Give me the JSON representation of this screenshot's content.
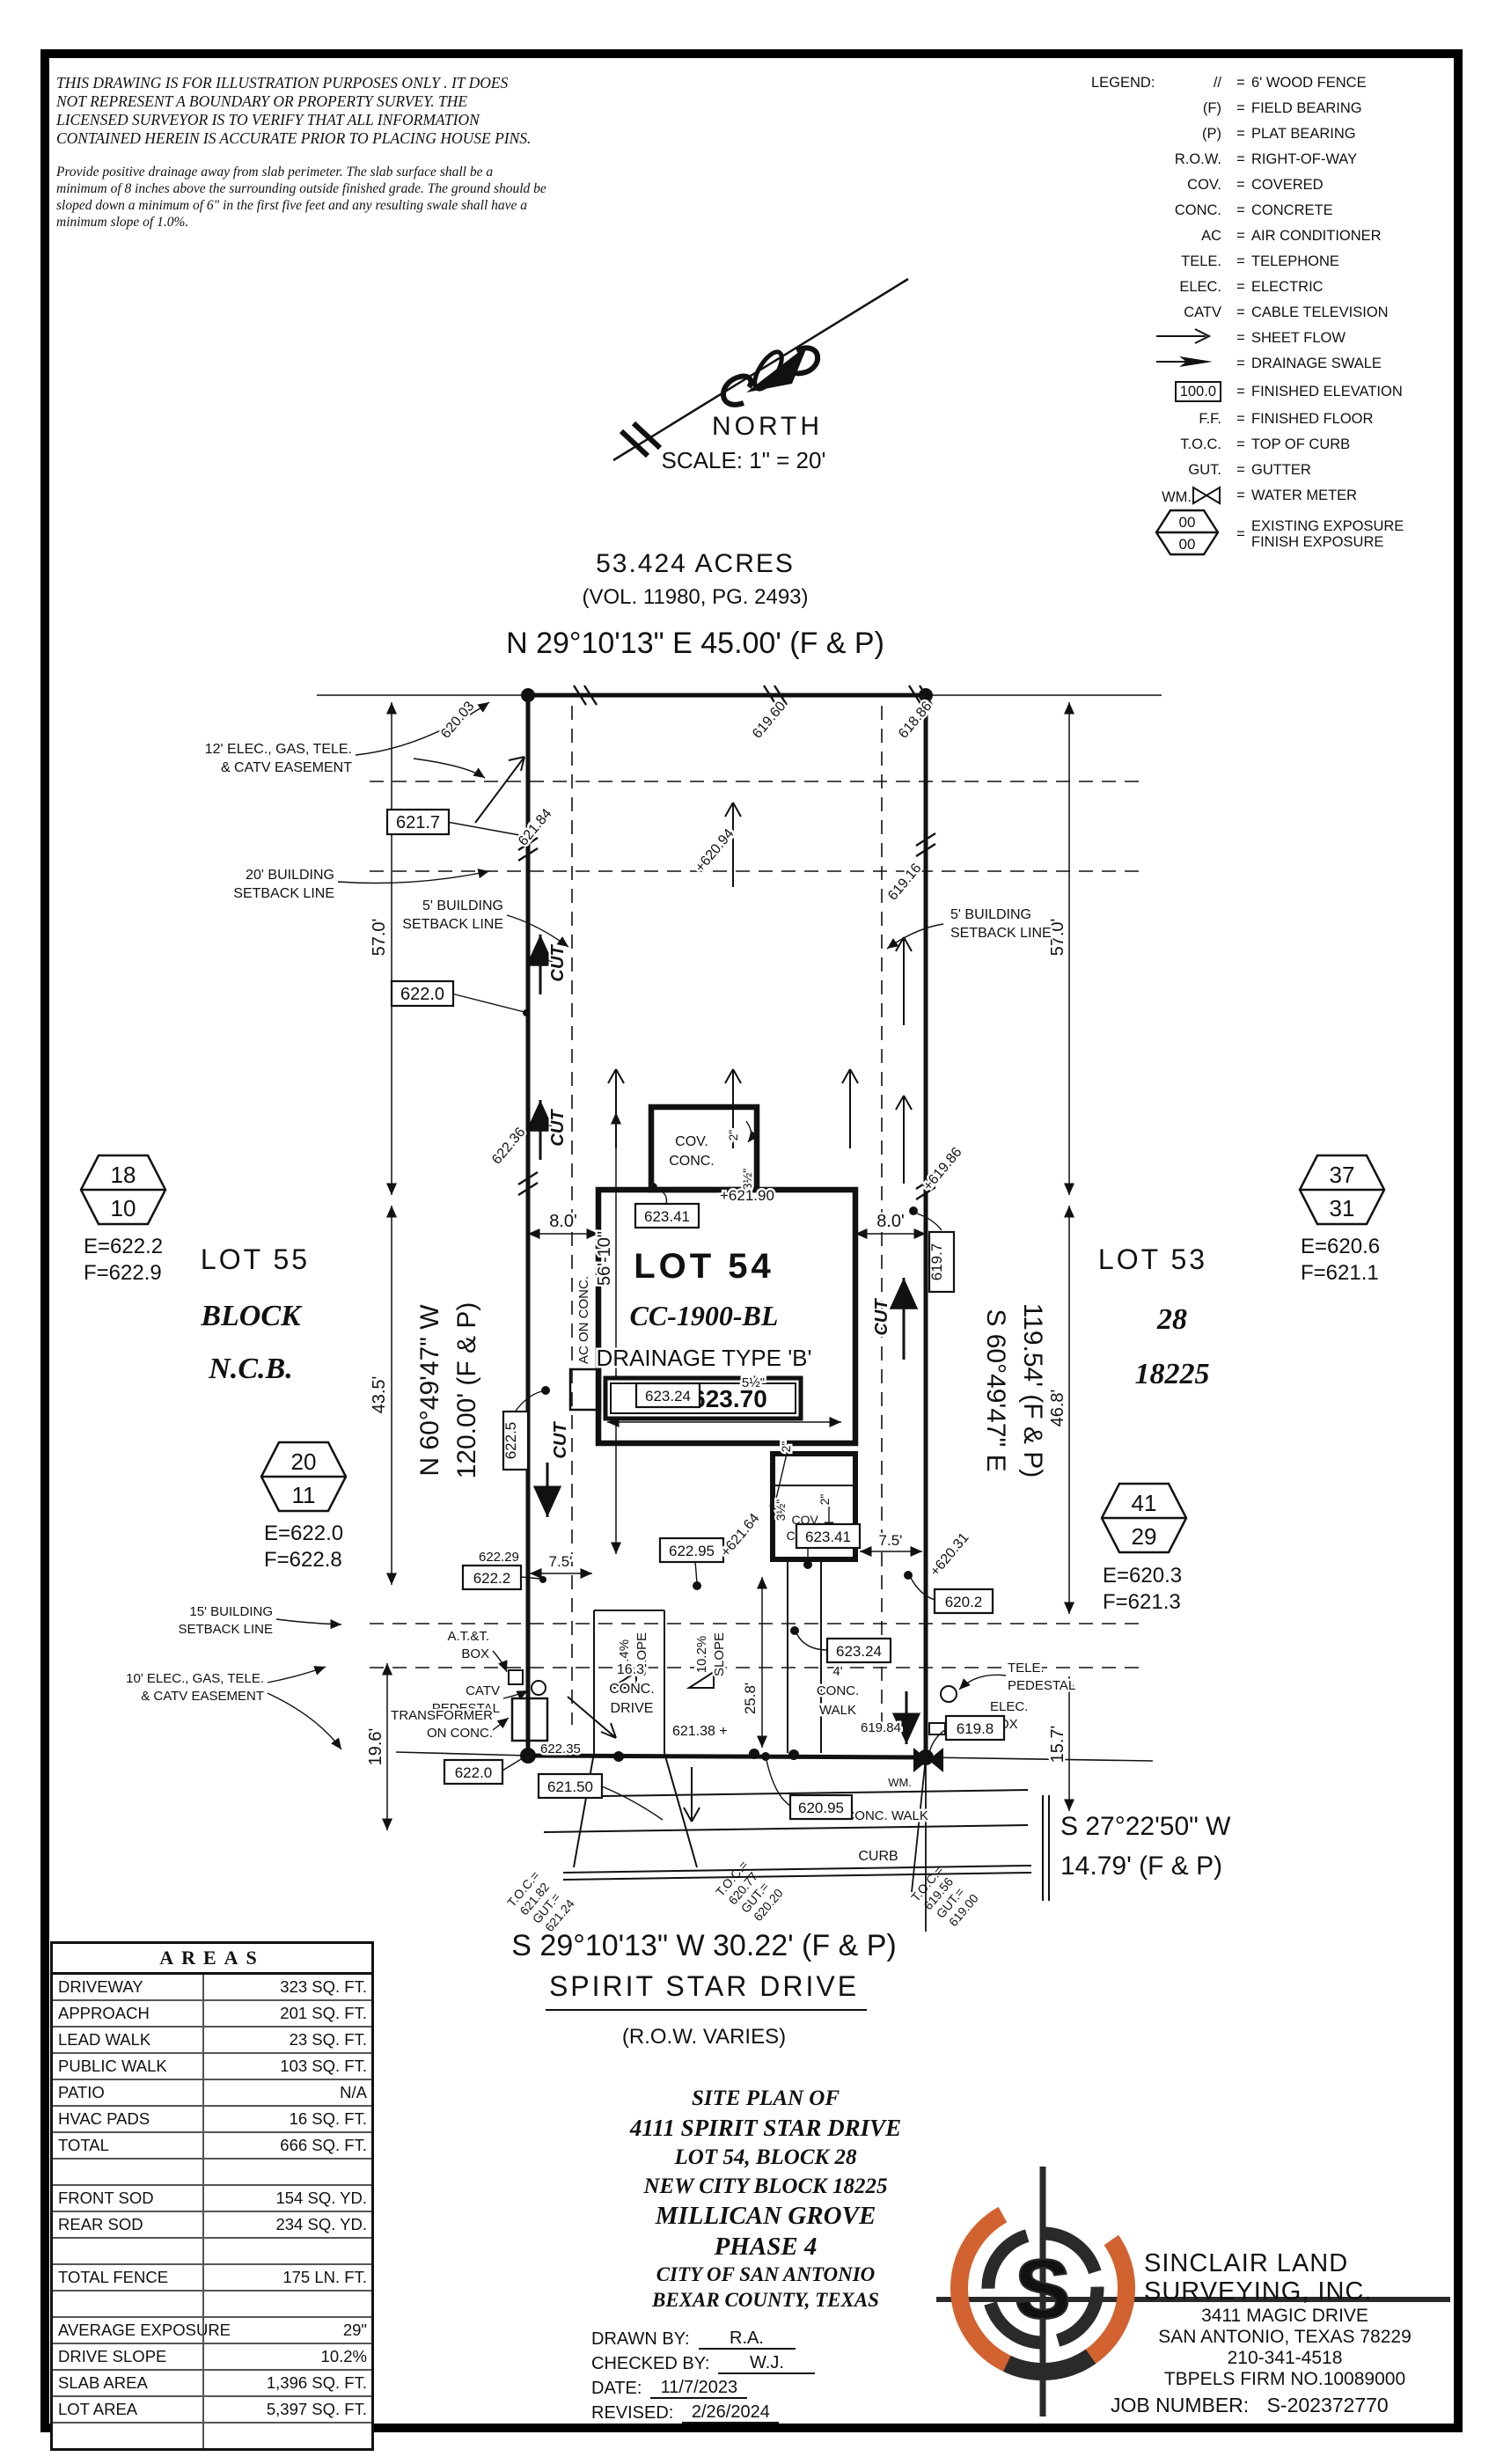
{
  "disclaimer": {
    "lines": [
      "THIS DRAWING IS FOR ILLUSTRATION PURPOSES ONLY . IT DOES",
      "NOT REPRESENT A BOUNDARY OR PROPERTY SURVEY. THE",
      "LICENSED SURVEYOR IS TO VERIFY THAT ALL INFORMATION",
      "CONTAINED HEREIN IS ACCURATE PRIOR TO PLACING HOUSE PINS."
    ]
  },
  "note": {
    "lines": [
      "Provide positive drainage away from slab perimeter. The slab surface shall be a",
      "minimum of 8 inches above the surrounding outside finished grade. The ground should be",
      "sloped down a minimum of 6\" in the first five feet and any resulting swale shall have a",
      "minimum slope of 1.0%."
    ]
  },
  "north": {
    "label": "NORTH",
    "scale": "SCALE: 1\" = 20'"
  },
  "legend": {
    "title": "LEGEND:",
    "fence_sym": "//",
    "fence": "6' WOOD FENCE",
    "f_sym": "(F)",
    "f": "FIELD BEARING",
    "p_sym": "(P)",
    "p": "PLAT BEARING",
    "row_sym": "R.O.W.",
    "row": "RIGHT-OF-WAY",
    "cov_sym": "COV.",
    "cov": "COVERED",
    "conc_sym": "CONC.",
    "conc": "CONCRETE",
    "ac_sym": "AC",
    "ac": "AIR CONDITIONER",
    "tele_sym": "TELE.",
    "tele": "TELEPHONE",
    "elec_sym": "ELEC.",
    "elec": "ELECTRIC",
    "catv_sym": "CATV",
    "catv": "CABLE TELEVISION",
    "sheet_flow": "SHEET FLOW",
    "swale": "DRAINAGE SWALE",
    "elev_value": "100.0",
    "finished_elev": "FINISHED ELEVATION",
    "ff_sym": "F.F.",
    "ff": "FINISHED FLOOR",
    "toc_sym": "T.O.C.",
    "toc": "TOP OF CURB",
    "gut_sym": "GUT.",
    "gut": "GUTTER",
    "wm_sym": "WM.",
    "wm": "WATER METER",
    "exposure_top": "00",
    "exposure_bottom": "00",
    "existing_exposure": "EXISTING EXPOSURE",
    "finish_exposure": "FINISH EXPOSURE"
  },
  "plat": {
    "acres": "53.424 ACRES",
    "vol": "(VOL. 11980, PG. 2493)",
    "bearing_top": "N 29°10'13\" E 45.00' (F & P)",
    "bearing_left1": "N 60°49'47\" W",
    "bearing_left2": "120.00' (F & P)",
    "bearing_right1": "S 60°49'47\" E",
    "bearing_right2": "119.54' (F & P)",
    "bearing_front": "S 29°10'13\" W 30.22' (F & P)",
    "street": "SPIRIT STAR DRIVE",
    "row_varies": "(R.O.W. VARIES)",
    "corner_bearing1": "S 27°22'50\" W",
    "corner_bearing2": "14.79' (F & P)",
    "esmt12a": "12' ELEC., GAS, TELE.",
    "esmt12b": "& CATV EASEMENT",
    "sb20a": "20' BUILDING",
    "sb20b": "SETBACK LINE",
    "sb5a": "5' BUILDING",
    "sb5b": "SETBACK LINE",
    "sb15a": "15' BUILDING",
    "sb15b": "SETBACK LINE",
    "esmt10a": "10' ELEC., GAS, TELE.",
    "esmt10b": "& CATV EASEMENT",
    "d57": "57.0'",
    "d43_5": "43.5'",
    "d46_8": "46.8'",
    "d19_6": "19.6'",
    "d15_7": "15.7'",
    "d8": "8.0'",
    "d7_5": "7.5'",
    "d25_8": "25.8'",
    "d56_10": "56'-10\"",
    "d29_11": "29'-11\"",
    "lot54": "LOT 54",
    "cc": "CC-1900-BL",
    "drainage": "DRAINAGE TYPE 'B'",
    "ff": "F.F.=623.70",
    "lot55": "LOT 55",
    "block_word": "BLOCK",
    "ncb": "N.C.B.",
    "lot53": "LOT 53",
    "blk28": "28",
    "ncb18225": "18225",
    "hex18": "18",
    "hex10": "10",
    "hex18_e": "E=622.2",
    "hex18_f": "F=622.9",
    "hex20": "20",
    "hex11": "11",
    "hex20_e": "E=622.0",
    "hex20_f": "F=622.8",
    "hex37": "37",
    "hex31": "31",
    "hex37_e": "E=620.6",
    "hex37_f": "F=621.1",
    "hex41": "41",
    "hex29": "29",
    "hex41_e": "E=620.3",
    "hex41_f": "F=621.3",
    "cov": "COV.",
    "conc": "CONC.",
    "ac_on_conc": "AC ON CONC.",
    "cut": "CUT",
    "in2": "2\"",
    "in3h": "3½\"",
    "in5h": "5½\"",
    "sl74": "7.4%",
    "sl102": "10.2%",
    "slope_word": "SLOPE",
    "dr1": "16.3'",
    "dr2": "CONC.",
    "dr3": "DRIVE",
    "wk1": "4'",
    "wk2": "CONC.",
    "wk3": "WALK",
    "walk_line": "4' CONC. WALK",
    "curb": "CURB",
    "att1": "A.T.&T.",
    "att2": "BOX",
    "catv1": "CATV",
    "catv2": "PEDESTAL",
    "xfmr1": "TRANSFORMER",
    "xfmr2": "ON CONC.",
    "tele1": "TELE.",
    "tele2": "PEDESTAL",
    "elec1": "ELEC.",
    "elec2": "BOX",
    "wm": "WM.",
    "b6217": "621.7",
    "b6220": "622.0",
    "b62341": "623.41",
    "b6225": "622.5",
    "b62324": "623.24",
    "b62295": "622.95",
    "b6222": "622.2",
    "b6202": "620.2",
    "b6197": "619.7",
    "b6198": "619.8",
    "b62095": "620.95",
    "b62150": "621.50",
    "s62003": "620.03",
    "s61960": "619.60",
    "s61886": "618.86",
    "s62184": "621.84",
    "s62094": "+620.94",
    "s61916": "619.16",
    "s62236": "622.36",
    "s61986": "+619.86",
    "s62190": "+621.90",
    "s62229": "622.29",
    "s62164": "+621.64",
    "s62031": "+620.31",
    "s62235": "622.35",
    "s62138": "621.38 +",
    "s61984": "619.84",
    "toc1a": "T.O.C.=",
    "toc1b": "621.82",
    "toc1c": "GUT.=",
    "toc1d": "621.24",
    "toc2a": "T.O.C.=",
    "toc2b": "620.77",
    "toc2c": "GUT.=",
    "toc2d": "620.20",
    "toc3a": "T.O.C.=",
    "toc3b": "619.56",
    "toc3c": "GUT.=",
    "toc3d": "619.00"
  },
  "areas": {
    "title": "AREAS",
    "rows": [
      {
        "label": "DRIVEWAY",
        "value": "323 SQ. FT."
      },
      {
        "label": "APPROACH",
        "value": "201 SQ. FT."
      },
      {
        "label": "LEAD WALK",
        "value": "23 SQ. FT."
      },
      {
        "label": "PUBLIC WALK",
        "value": "103 SQ. FT."
      },
      {
        "label": "PATIO",
        "value": "N/A"
      },
      {
        "label": "HVAC PADS",
        "value": "16 SQ. FT."
      },
      {
        "label": "TOTAL",
        "value": "666 SQ. FT."
      },
      {
        "label": "",
        "value": ""
      },
      {
        "label": "FRONT SOD",
        "value": "154 SQ. YD."
      },
      {
        "label": "REAR SOD",
        "value": "234 SQ. YD."
      },
      {
        "label": "",
        "value": ""
      },
      {
        "label": "TOTAL FENCE",
        "value": "175 LN. FT."
      },
      {
        "label": "",
        "value": ""
      },
      {
        "label": "AVERAGE EXPOSURE",
        "value": "29\""
      },
      {
        "label": "DRIVE SLOPE",
        "value": "10.2%"
      },
      {
        "label": "SLAB AREA",
        "value": "1,396 SQ. FT."
      },
      {
        "label": "LOT AREA",
        "value": "5,397 SQ. FT."
      },
      {
        "label": "",
        "value": ""
      }
    ]
  },
  "title_block": {
    "lines": [
      "SITE PLAN OF",
      "4111 SPIRIT STAR DRIVE",
      "LOT 54, BLOCK 28",
      "NEW CITY BLOCK 18225",
      "MILLICAN GROVE",
      "PHASE 4",
      "CITY OF SAN ANTONIO",
      "BEXAR COUNTY, TEXAS"
    ],
    "fields": [
      {
        "label": "DRAWN BY:",
        "value": "R.A."
      },
      {
        "label": "CHECKED BY:",
        "value": "W.J."
      },
      {
        "label": "DATE:",
        "value": "11/7/2023"
      },
      {
        "label": "REVISED:",
        "value": "2/26/2024"
      }
    ]
  },
  "surveyor": {
    "name1": "SINCLAIR LAND",
    "name2": "SURVEYING, INC.",
    "addr1": "3411 MAGIC DRIVE",
    "addr2": "SAN ANTONIO, TEXAS 78229",
    "phone": "210-341-4518",
    "firm": "TBPELS FIRM NO.10089000",
    "job_label": "JOB NUMBER:",
    "job_value": "S-202372770",
    "logo_letter": "S"
  },
  "colors": {
    "accent_orange": "#d2622f",
    "ink": "#111111"
  }
}
